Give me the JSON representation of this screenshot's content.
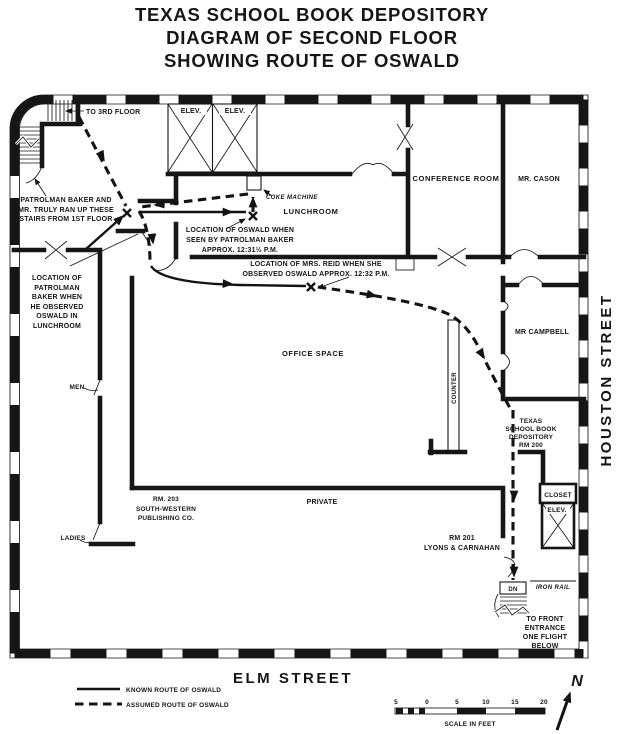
{
  "title": {
    "line1": "TEXAS SCHOOL BOOK DEPOSITORY",
    "line2": "DIAGRAM OF SECOND FLOOR",
    "line3": "SHOWING ROUTE OF OSWALD"
  },
  "streets": {
    "right": "HOUSTON STREET",
    "bottom": "ELM STREET"
  },
  "rooms": {
    "elev_left": "ELEV.",
    "elev_right": "ELEV.",
    "lunchroom": "LUNCHROOM",
    "conference": "CONFERENCE ROOM",
    "cason": "MR. CASON",
    "campbell": "MR CAMPBELL",
    "office": "OFFICE SPACE",
    "counter": "COUNTER",
    "men": "MEN",
    "ladies": "LADIES",
    "private": "PRIVATE",
    "closet": "CLOSET",
    "elev_small": "ELEV.",
    "dn": "DN",
    "iron_rail": "IRON RAIL"
  },
  "annotations": {
    "to_3rd_floor": "TO 3RD FLOOR",
    "coke_machine": "COKE MACHINE",
    "baker_truly": [
      "PATROLMAN BAKER AND",
      "MR. TRULY RAN UP THESE",
      "STAIRS FROM 1ST FLOOR"
    ],
    "oswald_seen": [
      "LOCATION OF OSWALD WHEN",
      "SEEN BY PATROLMAN BAKER",
      "APPROX. 12:31½ P.M."
    ],
    "baker_location": [
      "LOCATION OF",
      "PATROLMAN",
      "BAKER WHEN",
      "HE OBSERVED",
      "OSWALD IN",
      "LUNCHROOM"
    ],
    "reid_location": [
      "LOCATION OF MRS. REID WHEN SHE",
      "OBSERVED OSWALD APPROX. 12:32 P.M."
    ],
    "rm203": [
      "RM. 203",
      "SOUTH-WESTERN",
      "PUBLISHING CO."
    ],
    "rm201": [
      "RM 201",
      "LYONS & CARNAHAN"
    ],
    "tsbd_rm200": [
      "TEXAS",
      "SCHOOL BOOK",
      "DEPOSITORY",
      "RM 200"
    ],
    "front_entrance": [
      "TO FRONT",
      "ENTRANCE",
      "ONE FLIGHT",
      "BELOW"
    ]
  },
  "legend": {
    "known": "KNOWN ROUTE OF OSWALD",
    "assumed": "ASSUMED ROUTE OF OSWALD"
  },
  "scale": {
    "labels": [
      "5",
      "0",
      "5",
      "10",
      "15",
      "20"
    ],
    "caption": "SCALE IN FEET"
  },
  "compass": {
    "north": "N"
  },
  "colors": {
    "ink": "#161616",
    "paper": "#ffffff"
  }
}
